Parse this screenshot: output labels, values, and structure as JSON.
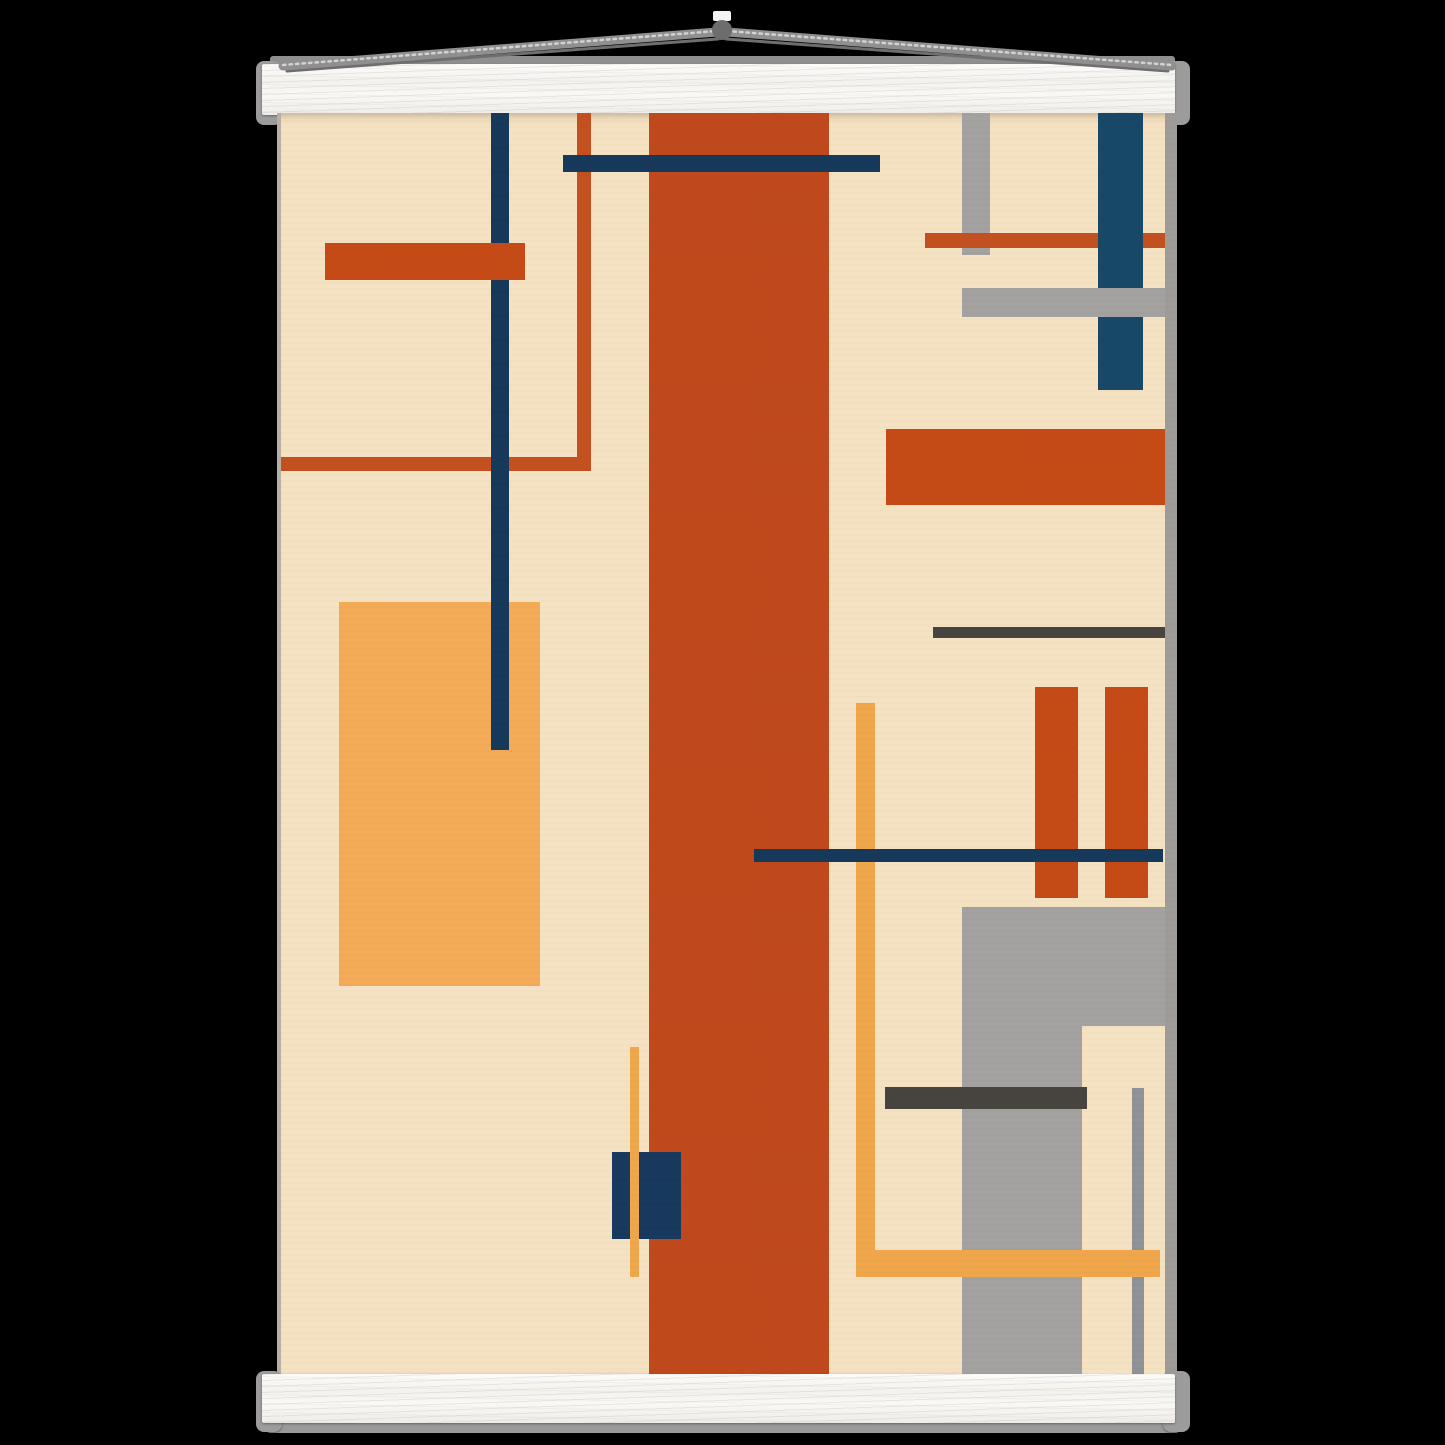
{
  "scene": {
    "description": "abstract-geometric-poster-mockup-with-wooden-hangers",
    "background_color": "#000000",
    "hanger": {
      "bar_face_color": "#f7f5f2",
      "cap_color": "#9c9c9c",
      "top_back_strip": {
        "x": 270,
        "y": 56,
        "w": 905,
        "h": 14,
        "color": "#8f8f8f"
      },
      "top_bar": {
        "x": 262,
        "y": 64,
        "w": 913,
        "h": 51
      },
      "top_cap_left": {
        "x": 256,
        "y": 61,
        "w": 26,
        "h": 64
      },
      "top_cap_right": {
        "x": 1163,
        "y": 61,
        "w": 27,
        "h": 64
      },
      "bottom_bar": {
        "x": 262,
        "y": 1374,
        "w": 913,
        "h": 49
      },
      "bottom_cap_left": {
        "x": 256,
        "y": 1371,
        "w": 26,
        "h": 61
      },
      "bottom_cap_right": {
        "x": 1163,
        "y": 1371,
        "w": 27,
        "h": 61
      },
      "bottom_under_strip": {
        "x": 267,
        "y": 1419,
        "w": 912,
        "h": 14,
        "color": "#9a9a9a"
      },
      "cord": {
        "color": "#8f8f8f",
        "highlight_color": "#d2d2d2",
        "shadow_color": "#6e6e6e",
        "apex_x": 722,
        "apex_y": 32,
        "left_anchor_x": 283,
        "right_anchor_x": 1172,
        "anchor_y": 66,
        "thickness": 9
      },
      "ring": {
        "cx": 722,
        "cy": 30,
        "r": 10,
        "color": "#6d6d6d"
      },
      "top_tab": {
        "x": 713,
        "y": 11,
        "w": 18,
        "h": 10,
        "color": "#f4f4f4"
      }
    },
    "poster": {
      "x": 277,
      "y": 113,
      "w": 900,
      "h": 1263,
      "paper_color": "#f5e2c2"
    },
    "artwork": {
      "palette": {
        "cream": "#f5e2c2",
        "burnt_orange": "#bf491c",
        "bright_orange": "#c64a16",
        "thin_orange": "#c3511f",
        "amber": "#f0a64a",
        "amber_block": "#f4ab58",
        "navy": "#16395b",
        "navy_wide": "#174868",
        "gray": "#a3a2a0",
        "gray_edge": "#9e9c99",
        "charcoal": "#474440"
      },
      "shapes": [
        {
          "name": "thin-orange-l-horizontal",
          "x": 0,
          "y": 344,
          "w": 314,
          "h": 14,
          "color": "#c3511f"
        },
        {
          "name": "thin-orange-l-vertical",
          "x": 300,
          "y": 0,
          "w": 14,
          "h": 358,
          "color": "#c3511f"
        },
        {
          "name": "amber-rect-left",
          "x": 62,
          "y": 489,
          "w": 201,
          "h": 384,
          "color": "#f4ab58"
        },
        {
          "name": "navy-thin-vertical-left",
          "x": 214,
          "y": 0,
          "w": 18,
          "h": 637,
          "color": "#16395b"
        },
        {
          "name": "orange-bar-topleft",
          "x": 48,
          "y": 130,
          "w": 200,
          "h": 37,
          "color": "#c64a16"
        },
        {
          "name": "burnt-orange-band-center",
          "x": 372,
          "y": 0,
          "w": 180,
          "h": 1263,
          "color": "#bf491c"
        },
        {
          "name": "navy-horizontal-top",
          "x": 286,
          "y": 42,
          "w": 317,
          "h": 17,
          "color": "#16395b"
        },
        {
          "name": "navy-rect-bottom-center",
          "x": 335,
          "y": 1039,
          "w": 69,
          "h": 87,
          "color": "#17395d"
        },
        {
          "name": "amber-thin-line-center",
          "x": 353,
          "y": 934,
          "w": 9,
          "h": 230,
          "color": "#f0a64a"
        },
        {
          "name": "gray-vertical-bar-topright",
          "x": 685,
          "y": 0,
          "w": 28,
          "h": 142,
          "color": "#a3a2a0"
        },
        {
          "name": "orange-line-topright",
          "x": 648,
          "y": 120,
          "w": 240,
          "h": 15,
          "color": "#c3511f"
        },
        {
          "name": "navy-wide-bar-topright",
          "x": 821,
          "y": 0,
          "w": 45,
          "h": 277,
          "color": "#174868"
        },
        {
          "name": "gray-horizontal-bar-topright",
          "x": 685,
          "y": 175,
          "w": 215,
          "h": 29,
          "color": "#a3a2a0"
        },
        {
          "name": "orange-bar-right",
          "x": 609,
          "y": 316,
          "w": 279,
          "h": 76,
          "color": "#c64a16"
        },
        {
          "name": "charcoal-line-right",
          "x": 656,
          "y": 514,
          "w": 232,
          "h": 11,
          "color": "#474440"
        },
        {
          "name": "orange-vbar-right-1",
          "x": 758,
          "y": 574,
          "w": 43,
          "h": 211,
          "color": "#c64a16"
        },
        {
          "name": "orange-vbar-right-2",
          "x": 828,
          "y": 574,
          "w": 43,
          "h": 211,
          "color": "#c64a16"
        },
        {
          "name": "amber-l-vertical-right",
          "x": 579,
          "y": 590,
          "w": 19,
          "h": 574,
          "color": "#f0a64a"
        },
        {
          "name": "navy-horizontal-middle",
          "x": 477,
          "y": 736,
          "w": 409,
          "h": 13,
          "color": "#16395b"
        },
        {
          "name": "gray-rect-bottomright",
          "x": 685,
          "y": 794,
          "w": 215,
          "h": 469,
          "color": "#a3a2a0"
        },
        {
          "name": "cream-notch-bottomright",
          "x": 805,
          "y": 913,
          "w": 83,
          "h": 350,
          "color": "#f5e2c2"
        },
        {
          "name": "thin-gray-line-bottomright",
          "x": 855,
          "y": 975,
          "w": 12,
          "h": 288,
          "color": "#8f9296"
        },
        {
          "name": "charcoal-bar-bottomright",
          "x": 608,
          "y": 974,
          "w": 202,
          "h": 22,
          "color": "#474440"
        },
        {
          "name": "amber-l-horizontal-right",
          "x": 579,
          "y": 1137,
          "w": 304,
          "h": 27,
          "color": "#f0a64a"
        },
        {
          "name": "gray-right-edge-strip",
          "x": 888,
          "y": 0,
          "w": 12,
          "h": 1263,
          "color": "#9e9c99"
        },
        {
          "name": "left-edge-shadow",
          "x": 0,
          "y": 0,
          "w": 4,
          "h": 1263,
          "color": "#b6b0a6"
        }
      ]
    }
  }
}
